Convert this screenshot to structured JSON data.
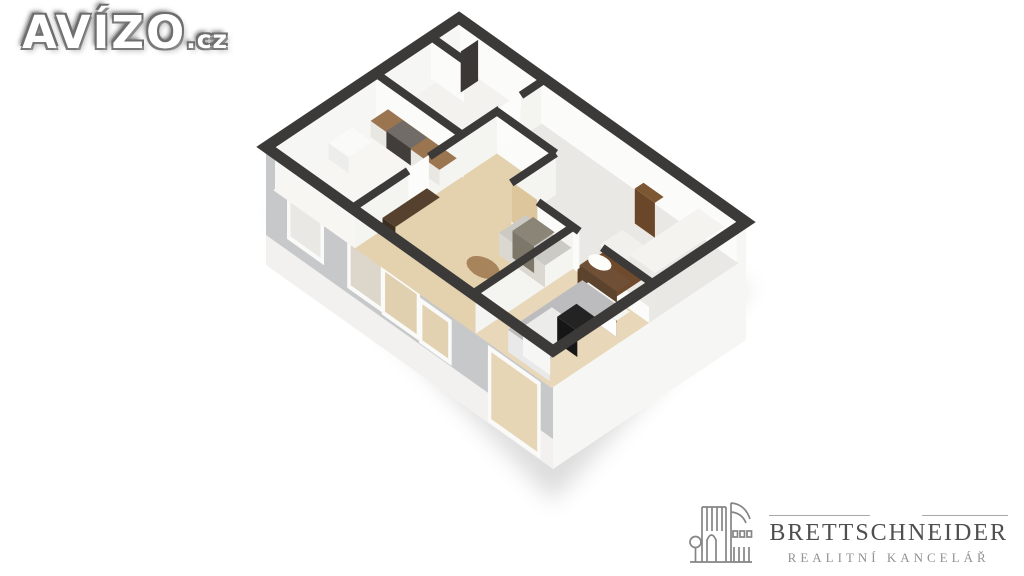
{
  "watermark": {
    "brand": "AVÍZO",
    "tld": ".cz"
  },
  "agency": {
    "name": "BRETTSCHNEIDER",
    "subtitle": "REALITNÍ KANCELÁŘ",
    "icon": "building-with-tree-line-art-icon"
  },
  "palette": {
    "background": "#ffffff",
    "wall_cut": "#3b3a39",
    "wall_sw_face": "#c6c8c9",
    "wall_se_face": "#f6f6f4",
    "wall_slab": "#f2f1ef",
    "interior_face_bright": "#fbfbfa",
    "interior_face_dim": "#f4f4f1",
    "floor_bathroom": "#f3f2ef",
    "floor_kitchen": "#f7f6f3",
    "floor_hall": "#eae8e4",
    "floor_living": "#e4d1ad",
    "floor_bedroom": "#e8d7b8",
    "wood_counter": "#9a7550",
    "wood_dark": "#55412d",
    "sofa_gray": "#cccac4",
    "bed_duvet": "#bcbcbf",
    "shadow": "#8f8f8f",
    "logo_title": "#4f4f4f",
    "logo_subtitle": "#929292",
    "avizo_outline": "#6e6e6e"
  },
  "floorplan": {
    "origin": [
      459,
      18
    ],
    "axis_u": [
      287,
      204
    ],
    "axis_v": [
      -193,
      129
    ],
    "floor_drop": 42,
    "wall_bottom": 90,
    "slab_bottom": 118,
    "shadow_pts": [
      [
        0.02,
        1.0,
        60
      ],
      [
        1.0,
        1.0,
        150
      ],
      [
        1.02,
        0.0,
        60
      ]
    ],
    "rooms": [
      {
        "name": "bathroom",
        "u": [
          0.015,
          0.3
        ],
        "v": [
          0.015,
          0.43
        ],
        "fill": "#f3f2ef"
      },
      {
        "name": "kitchen",
        "u": [
          0.015,
          0.3
        ],
        "v": [
          0.43,
          0.985
        ],
        "fill": "#f7f6f3"
      },
      {
        "name": "living-room",
        "u": [
          0.3,
          0.72
        ],
        "v": [
          0.25,
          0.985
        ],
        "fill": "#e4d1ad"
      },
      {
        "name": "hallway-a",
        "u": [
          0.3,
          0.985
        ],
        "v": [
          0.015,
          0.25
        ],
        "fill": "#eae8e4"
      },
      {
        "name": "hallway-b",
        "u": [
          0.505,
          0.985
        ],
        "v": [
          0.25,
          0.48
        ],
        "fill": "#eae8e4"
      },
      {
        "name": "bedroom",
        "u": [
          0.72,
          0.985
        ],
        "v": [
          0.48,
          0.985
        ],
        "fill": "#e8d7b8"
      }
    ],
    "inner_walls": [
      [
        0.0,
        0.43,
        0.305,
        0.43
      ],
      [
        0.3,
        0.0,
        0.3,
        0.125
      ],
      [
        0.3,
        0.235,
        0.3,
        0.6
      ],
      [
        0.3,
        0.71,
        0.3,
        1.0
      ],
      [
        0.3,
        0.25,
        0.505,
        0.25
      ],
      [
        0.505,
        0.25,
        0.505,
        0.48
      ],
      [
        0.598,
        0.48,
        0.742,
        0.48
      ],
      [
        0.822,
        0.48,
        1.0,
        0.48
      ],
      [
        0.72,
        0.48,
        0.72,
        1.0
      ],
      [
        0.0,
        0.145,
        0.115,
        0.145
      ]
    ],
    "faces": [
      [
        0.018,
        0.02,
        0.018,
        0.98,
        "#f6f6f4"
      ],
      [
        0.02,
        0.018,
        0.98,
        0.018,
        "#fbfbfa"
      ],
      [
        0.0,
        0.43,
        0.305,
        0.43,
        "#fbfbfa"
      ],
      [
        0.3,
        0.02,
        0.3,
        0.125,
        "#f4f4f1"
      ],
      [
        0.3,
        0.235,
        0.3,
        0.6,
        "#f4f4f1"
      ],
      [
        0.3,
        0.71,
        0.3,
        0.985,
        "#f4f4f1"
      ],
      [
        0.3,
        0.25,
        0.505,
        0.25,
        "#fbfbfa"
      ],
      [
        0.505,
        0.25,
        0.505,
        0.48,
        "#f4f4f1"
      ],
      [
        0.598,
        0.48,
        0.742,
        0.48,
        "#fbfbfa"
      ],
      [
        0.822,
        0.48,
        0.985,
        0.48,
        "#fbfbfa"
      ],
      [
        0.72,
        0.48,
        0.72,
        0.985,
        "#f4f4f1"
      ],
      [
        0.0,
        0.145,
        0.115,
        0.145,
        "#fbfbfa"
      ]
    ],
    "windows": [
      {
        "name": "kitchen-window",
        "u": [
          0.085,
          0.19
        ],
        "d": [
          22,
          72
        ],
        "inner": "#e9e8e5"
      },
      {
        "name": "living-window-1",
        "u": [
          0.295,
          0.4
        ],
        "d": [
          30,
          78
        ],
        "inner": "#ddd6ca"
      },
      {
        "name": "living-window-2",
        "u": [
          0.415,
          0.525
        ],
        "d": [
          40,
          80
        ],
        "inner": "#e1d0af"
      },
      {
        "name": "living-window-3",
        "u": [
          0.545,
          0.635
        ],
        "d": [
          46,
          82
        ],
        "inner": "#e3d2b1"
      },
      {
        "name": "bedroom-window",
        "u": [
          0.785,
          0.945
        ],
        "d": [
          45,
          112
        ],
        "inner": "#e7d6b6"
      }
    ],
    "furniture": [
      {
        "name": "kitchen-sink",
        "kind": "box",
        "u": [
          0.03,
          0.1
        ],
        "v": [
          0.6,
          0.72
        ],
        "top": 26,
        "fill": "#fafaf8",
        "face": "#ededeb"
      },
      {
        "name": "kitchen-counter",
        "kind": "box",
        "u": [
          0.045,
          0.285
        ],
        "v": [
          0.435,
          0.525
        ],
        "top": 26,
        "fill": "#9a7550",
        "face": "#e9e7e2"
      },
      {
        "name": "stove",
        "kind": "box",
        "u": [
          0.1,
          0.185
        ],
        "v": [
          0.44,
          0.525
        ],
        "top": 25,
        "fill": "#716c67",
        "face": "#413d3a"
      },
      {
        "name": "shower-panel",
        "kind": "slab",
        "a": [
          0.1,
          0.05
        ],
        "b": [
          0.1,
          0.14
        ],
        "top": -5,
        "bottom": 36,
        "fill": "#3a3734"
      },
      {
        "name": "bathroom-door-leaf",
        "kind": "slab",
        "a": [
          0.3,
          0.128
        ],
        "b": [
          0.3,
          0.232
        ],
        "top": -2,
        "bottom": 38,
        "fill": "#fcfcfa"
      },
      {
        "name": "kitchen-door-leaf",
        "kind": "slab",
        "a": [
          0.3,
          0.602
        ],
        "b": [
          0.3,
          0.708
        ],
        "top": -2,
        "bottom": 38,
        "fill": "#fcfcfa"
      },
      {
        "name": "hall-shelf",
        "kind": "box",
        "u": [
          0.71,
          0.78
        ],
        "v": [
          0.1,
          0.145
        ],
        "top": 7,
        "fill": "#7d5733",
        "face": "#6a4728"
      },
      {
        "name": "hall-cabinet",
        "kind": "box",
        "u": [
          0.83,
          0.89
        ],
        "v": [
          0.25,
          0.37
        ],
        "top": 22,
        "fill": "#d8c79e",
        "face": "#cbb990"
      },
      {
        "name": "hall-wardrobe-arm",
        "kind": "box",
        "u": [
          0.77,
          0.875
        ],
        "v": [
          0.3,
          0.42
        ],
        "top": 16,
        "fill": "#f1f0ec",
        "face": "#e7e5e0"
      },
      {
        "name": "hall-wardrobe",
        "kind": "box",
        "u": [
          0.875,
          0.965
        ],
        "v": [
          0.06,
          0.42
        ],
        "top": 4,
        "fill": "#f4f3ef",
        "face": "#ebe9e4"
      },
      {
        "name": "tv-cabinet",
        "kind": "box",
        "u": [
          0.305,
          0.35
        ],
        "v": [
          0.62,
          0.85
        ],
        "top": 28,
        "fill": "#55412d",
        "face": "#3b2d1f"
      },
      {
        "name": "living-door-leaf",
        "kind": "slab",
        "a": [
          0.507,
          0.482
        ],
        "b": [
          0.596,
          0.482
        ],
        "top": -2,
        "bottom": 38,
        "fill": "#ddc69c"
      },
      {
        "name": "sofa",
        "kind": "box",
        "u": [
          0.56,
          0.72
        ],
        "v": [
          0.487,
          0.625
        ],
        "top": 20,
        "fill": "#cccac4",
        "face": "#dbd8d2"
      },
      {
        "name": "sofa-cushion",
        "kind": "box",
        "u": [
          0.59,
          0.665
        ],
        "v": [
          0.493,
          0.6
        ],
        "top": 15,
        "fill": "#8b8578",
        "face": "#7d7769"
      },
      {
        "name": "coffee-table",
        "kind": "disc",
        "c": [
          0.575,
          0.73
        ],
        "r": 0.048,
        "top": 38,
        "fill": "#a8845c"
      },
      {
        "name": "bedroom-wall-shelves",
        "kind": "box",
        "u": [
          0.83,
          0.965
        ],
        "v": [
          0.487,
          0.62
        ],
        "top": 2,
        "fill": "#6f4a2c",
        "face": "#5d3c22"
      },
      {
        "name": "desk",
        "kind": "box",
        "u": [
          0.8,
          0.93
        ],
        "v": [
          0.49,
          0.565
        ],
        "top": 11,
        "fill": "#6f5036",
        "face": "#5c432e"
      },
      {
        "name": "bedside-lamp",
        "kind": "disc",
        "c": [
          0.84,
          0.52
        ],
        "r": 0.034,
        "top": 6,
        "fill": "#fdfdf9"
      },
      {
        "name": "bed-frame",
        "kind": "box",
        "u": [
          0.82,
          0.965
        ],
        "v": [
          0.55,
          0.62
        ],
        "top": 26,
        "fill": "#f5f5f3",
        "face": "#ffffff"
      },
      {
        "name": "bed",
        "kind": "box",
        "u": [
          0.82,
          0.965
        ],
        "v": [
          0.58,
          0.965
        ],
        "top": 20,
        "fill": "#bcbcbf",
        "face": "#e9e9ea"
      },
      {
        "name": "bed-pillows",
        "kind": "box",
        "u": [
          0.855,
          0.95
        ],
        "v": [
          0.79,
          0.94
        ],
        "top": 13,
        "fill": "#ececea",
        "face": "#f6f6f5"
      },
      {
        "name": "desk-chair",
        "kind": "box",
        "u": [
          0.88,
          0.95
        ],
        "v": [
          0.7,
          0.8
        ],
        "top": 16,
        "fill": "#232323",
        "face": "#161616"
      }
    ]
  }
}
